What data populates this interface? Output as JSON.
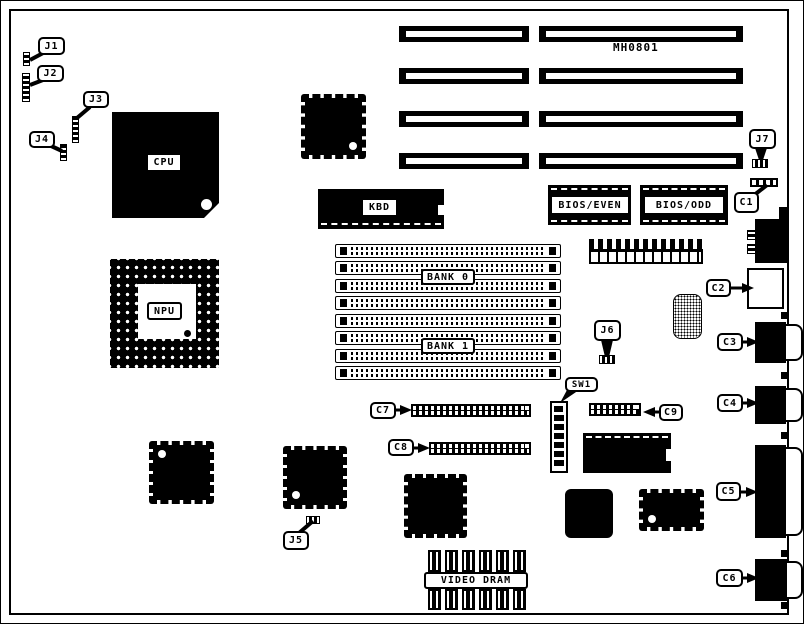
{
  "title": "MH0801",
  "colors": {
    "ink": "#000000",
    "paper": "#ffffff"
  },
  "chips": {
    "cpu": "CPU",
    "npu": "NPU",
    "kbd": "KBD",
    "bios_even": "BIOS/EVEN",
    "bios_odd": "BIOS/ODD",
    "bank0": "BANK 0",
    "bank1": "BANK 1",
    "video_dram": "VIDEO DRAM"
  },
  "callouts": {
    "j1": "J1",
    "j2": "J2",
    "j3": "J3",
    "j4": "J4",
    "j5": "J5",
    "j6": "J6",
    "j7": "J7",
    "c1": "C1",
    "c2": "C2",
    "c3": "C3",
    "c4": "C4",
    "c5": "C5",
    "c6": "C6",
    "c7": "C7",
    "c8": "C8",
    "c9": "C9",
    "sw1": "SW1"
  }
}
